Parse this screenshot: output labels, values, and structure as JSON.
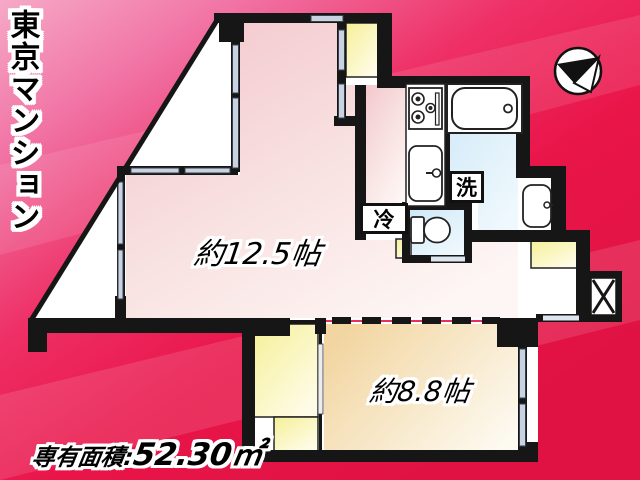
{
  "flyer": {
    "building_title": "東京マンション",
    "area_caption": {
      "prefix": "専有面積:",
      "value": "52.30㎡"
    }
  },
  "floor_plan": {
    "living_dining_kitchen": {
      "size_label": "約12.5帖"
    },
    "bedroom": {
      "size_label": "約8.8帖"
    },
    "refrigerator_space": {
      "label": "冷"
    },
    "washing_machine_space": {
      "label": "洗"
    }
  },
  "colors": {
    "background_red": "#e91549",
    "background_pink": "#f6a9c7",
    "living_room_pink": "#f2c5cb",
    "bedroom_beige": "#f2d5a0",
    "closet_yellow": "#f6f098",
    "wet_area_blue": "#cfe8f7",
    "wall_black": "#161616"
  }
}
